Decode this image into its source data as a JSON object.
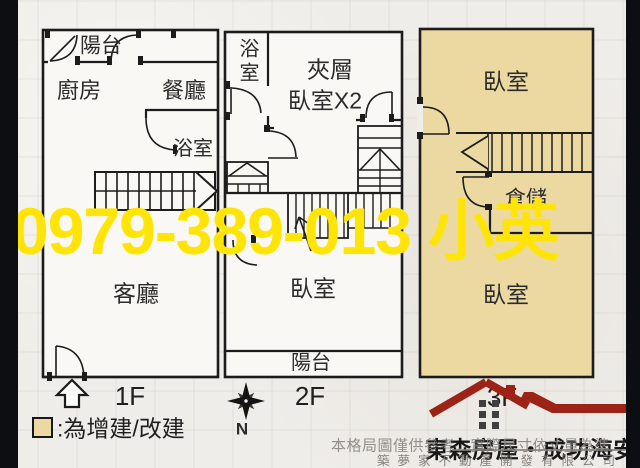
{
  "watermark": {
    "text": "0979-389-013 小英"
  },
  "plans": {
    "f1": {
      "label": "1F",
      "balcony": "陽台",
      "kitchen": "廚房",
      "dining": "餐廳",
      "bathroom": "浴室",
      "living": "客廳"
    },
    "f2": {
      "label": "2F",
      "bathroom": "浴室",
      "mezzanine_l1": "夾層",
      "mezzanine_l2": "臥室X2",
      "bedroom": "臥室",
      "balcony": "陽台"
    },
    "f3": {
      "label": "3F",
      "bedroom_top": "臥室",
      "storage": "倉儲",
      "bedroom_bottom": "臥室"
    }
  },
  "compass": {
    "north": "N"
  },
  "legend": {
    "text": ":為增建/改建"
  },
  "footer": {
    "brand": "東森房屋・成功海安",
    "disclaimer": "本格局圖僅供參考．實際尺寸依丈量為準",
    "company": "築夢家不動產開發有限公司"
  },
  "colors": {
    "highlight_fill": "#ECD9A2",
    "watermark_yellow": "#FFE408",
    "logo_red": "#9E2317",
    "line": "#1C1C1C"
  }
}
